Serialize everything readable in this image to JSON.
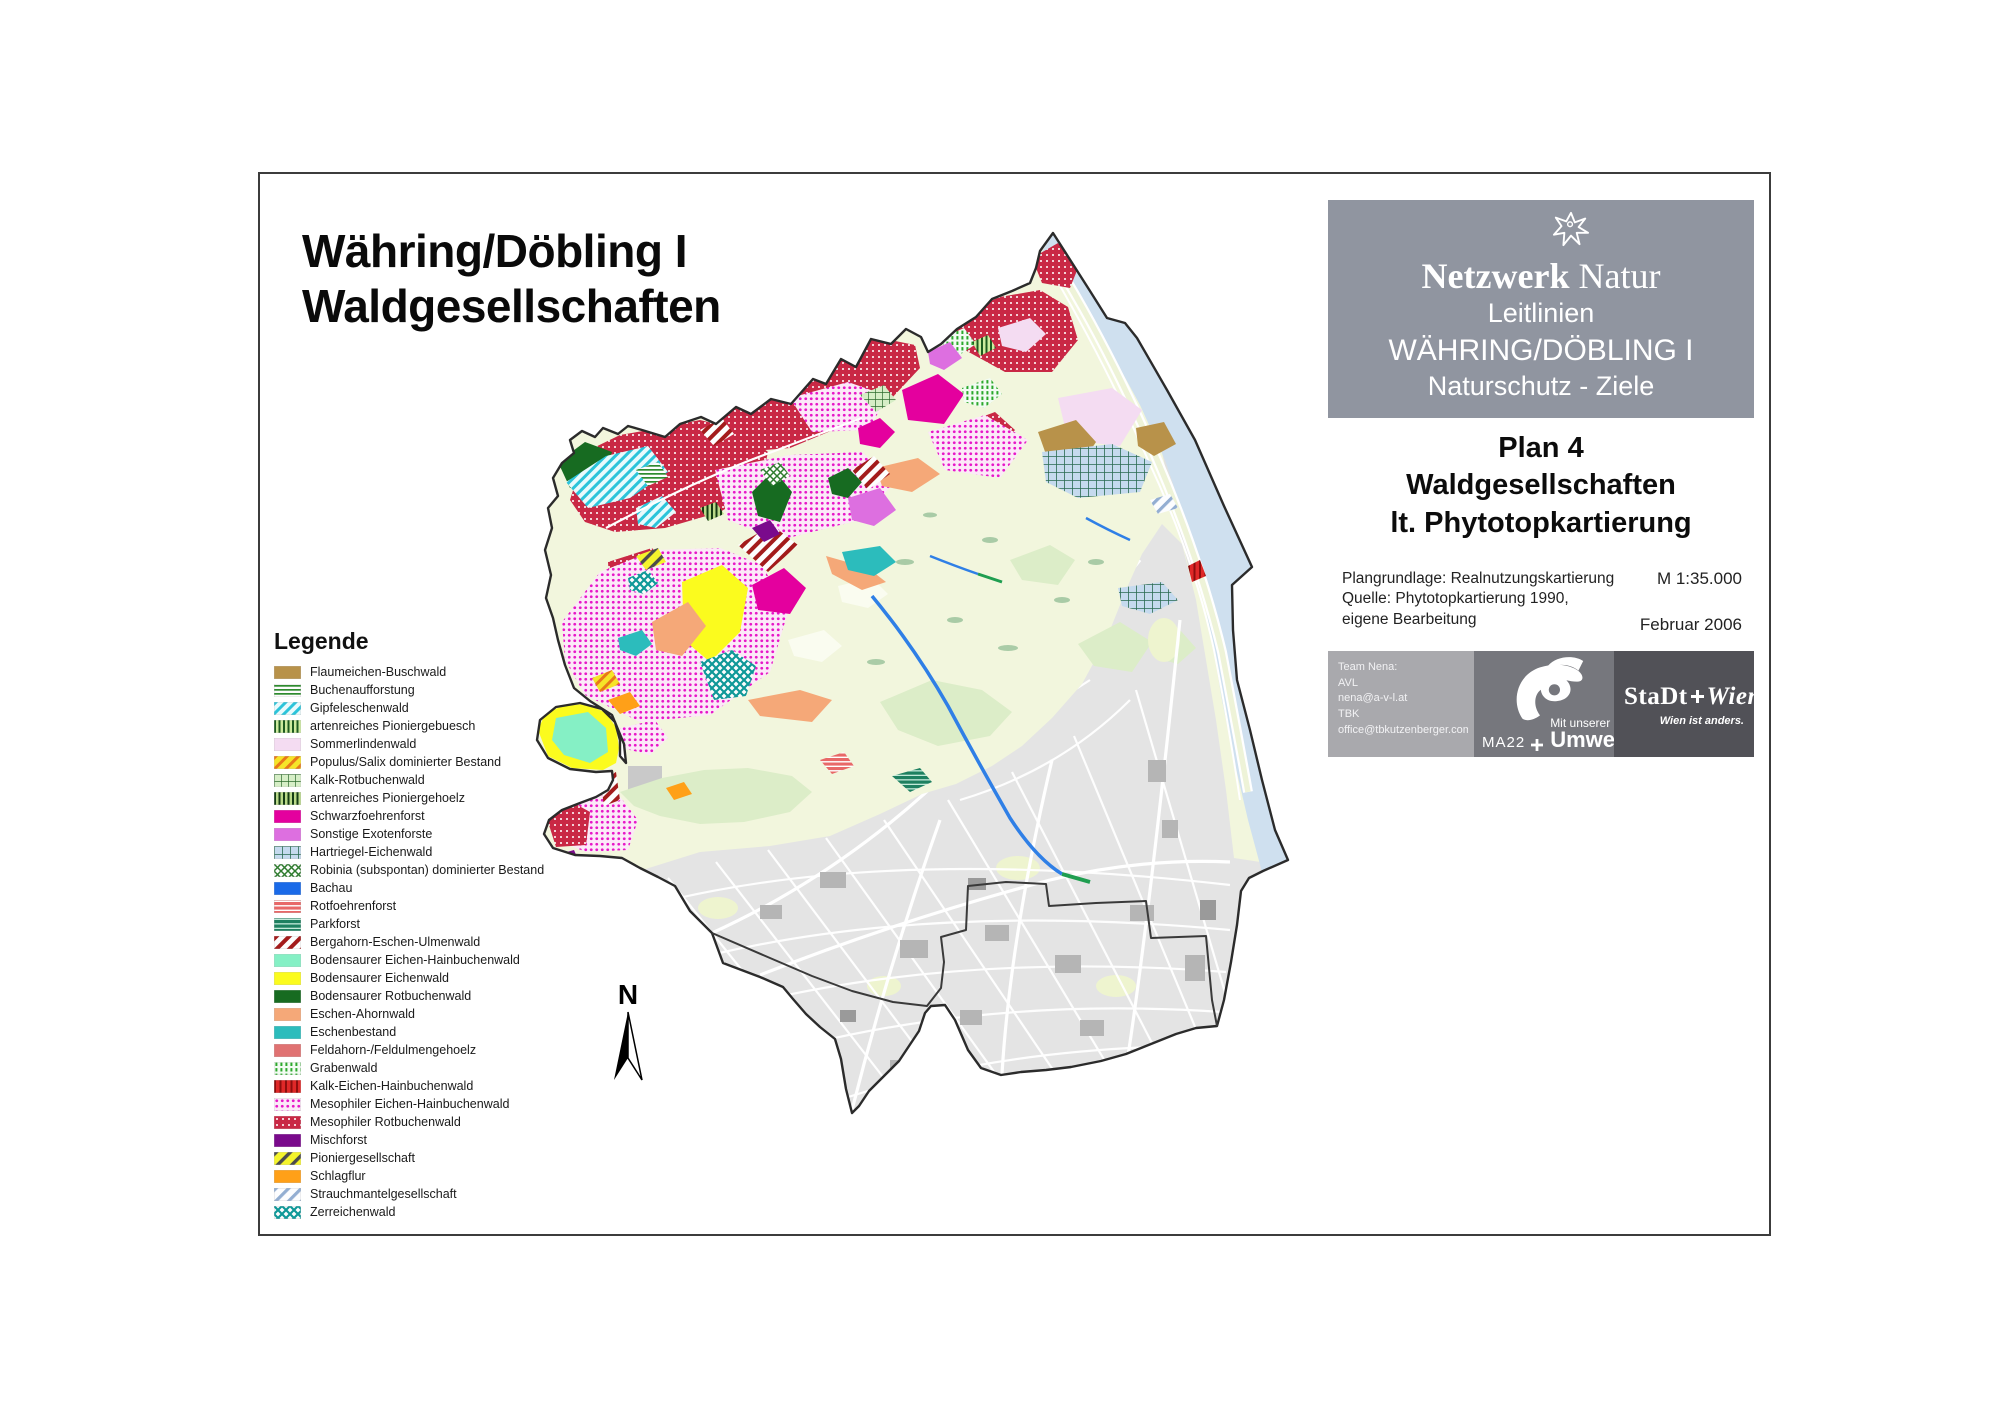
{
  "title": {
    "line1": "Währing/Döbling I",
    "line2": "Waldgesellschaften"
  },
  "map": {
    "north_label": "N"
  },
  "legend": {
    "heading": "Legende",
    "items": [
      {
        "label": "Flaumeichen-Buschwald",
        "fill": "#b8924a"
      },
      {
        "label": "Buchenaufforstung",
        "fill": "p-buch"
      },
      {
        "label": "Gipfeleschenwald",
        "fill": "p-gipf"
      },
      {
        "label": "artenreiches Pioniergebuesch",
        "fill": "p-pgeb"
      },
      {
        "label": "Sommerlindenwald",
        "fill": "#f4dcf2"
      },
      {
        "label": "Populus/Salix dominierter Bestand",
        "fill": "p-pop"
      },
      {
        "label": "Kalk-Rotbuchenwald",
        "fill": "p-krot"
      },
      {
        "label": "artenreiches Pioniergehoelz",
        "fill": "p-pgeh"
      },
      {
        "label": "Schwarzfoehrenforst",
        "fill": "#e4009e"
      },
      {
        "label": "Sonstige Exotenforste",
        "fill": "#dd6fe0"
      },
      {
        "label": "Hartriegel-Eichenwald",
        "fill": "p-hart"
      },
      {
        "label": "Robinia (subspontan) dominierter Bestand",
        "fill": "p-rob"
      },
      {
        "label": "Bachau",
        "fill": "#1a6ae8"
      },
      {
        "label": "Rotfoehrenforst",
        "fill": "p-rotf"
      },
      {
        "label": "Parkforst",
        "fill": "p-park"
      },
      {
        "label": "Bergahorn-Eschen-Ulmenwald",
        "fill": "p-berg"
      },
      {
        "label": "Bodensaurer Eichen-Hainbuchenwald",
        "fill": "#85f0c5"
      },
      {
        "label": "Bodensaurer Eichenwald",
        "fill": "#fbfb1e"
      },
      {
        "label": "Bodensaurer Rotbuchenwald",
        "fill": "#176b21"
      },
      {
        "label": "Eschen-Ahornwald",
        "fill": "#f5a878"
      },
      {
        "label": "Eschenbestand",
        "fill": "#2cbcbc"
      },
      {
        "label": "Feldahorn-/Feldulmengehoelz",
        "fill": "#e07272"
      },
      {
        "label": "Grabenwald",
        "fill": "p-grab"
      },
      {
        "label": "Kalk-Eichen-Hainbuchenwald",
        "fill": "p-keich"
      },
      {
        "label": "Mesophiler Eichen-Hainbuchenwald",
        "fill": "p-meiche"
      },
      {
        "label": "Mesophiler Rotbuchenwald",
        "fill": "p-mrot"
      },
      {
        "label": "Mischforst",
        "fill": "#7a0a8c"
      },
      {
        "label": "Pioniergesellschaft",
        "fill": "p-pion"
      },
      {
        "label": "Schlagflur",
        "fill": "#ffa018"
      },
      {
        "label": "Strauchmantelgesellschaft",
        "fill": "p-strauch"
      },
      {
        "label": "Zerreichenwald",
        "fill": "p-zerr"
      }
    ]
  },
  "info_panel": {
    "header": {
      "brand_bold": "Netzwerk",
      "brand_regular": " Natur",
      "subtitle1": "Leitlinien",
      "subtitle2": "WÄHRING/DÖBLING I",
      "subtitle3": "Naturschutz - Ziele"
    },
    "plan_block": {
      "line1": "Plan 4",
      "line2": "Waldgesellschaften",
      "line3": "lt. Phytotopkartierung"
    },
    "meta": {
      "basis": "Plangrundlage: Realnutzungskartierung",
      "source1": "Quelle: Phytotopkartierung 1990,",
      "source2": "eigene Bearbeitung",
      "scale": "M 1:35.000",
      "date": "Februar 2006"
    },
    "credits": [
      "Team Nena:",
      "AVL",
      "nena@a-v-l.at",
      "TBK",
      "office@tbkutzenberger.com"
    ],
    "ma22": {
      "code": "MA22",
      "tagline_small": "Mit unserer",
      "tagline_large": "Umwelt"
    },
    "stadt_wien": {
      "word1": "StaDt",
      "word2": "Wien",
      "claim": "Wien ist anders."
    }
  },
  "colors": {
    "panel_gray": "#9095a0",
    "district_background": "#f2f6dd",
    "urban_gray": "#e4e4e4",
    "danube_blue": "#cfe0ef",
    "forest_crimson": "#c92845",
    "forest_magenta": "#e718c8",
    "schwarzfoehren_magenta": "#e4009e"
  }
}
